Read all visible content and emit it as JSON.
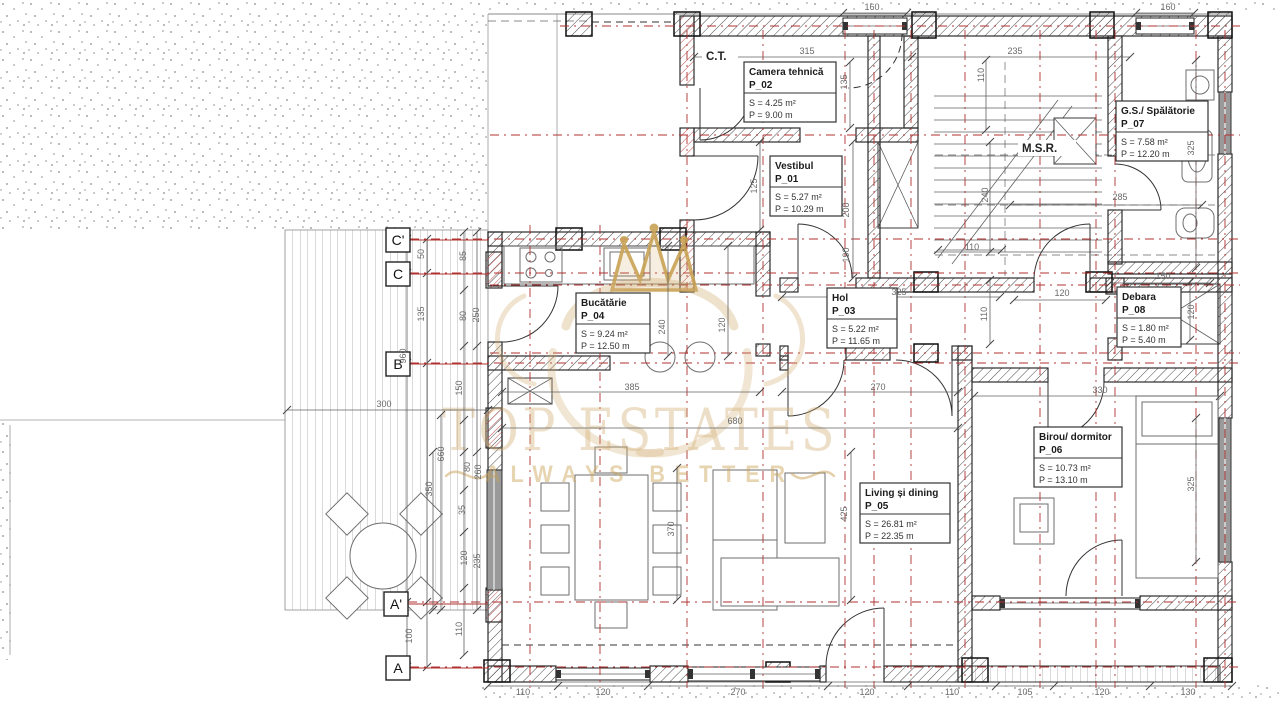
{
  "plan": {
    "watermark": {
      "line1": "TOP ESTATES",
      "line2": "ALWAYS BETTER"
    },
    "small_labels": [
      {
        "id": "ct",
        "text": "C.T.",
        "x": 706,
        "y": 60,
        "w": 36
      },
      {
        "id": "msr",
        "text": "M.S.R.",
        "x": 1022,
        "y": 152,
        "w": 58
      }
    ],
    "rooms": [
      {
        "id": "vestibul",
        "name": "Vestibul",
        "code": "P_01",
        "area": "S = 5.27 m²",
        "perimeter": "P = 10.29 m",
        "x": 770,
        "y": 156,
        "w": 72
      },
      {
        "id": "camera-tehnica",
        "name": "Camera tehnică",
        "code": "P_02",
        "area": "S = 4.25 m²",
        "perimeter": "P = 9.00 m",
        "x": 744,
        "y": 62,
        "w": 92
      },
      {
        "id": "hol",
        "name": "Hol",
        "code": "P_03",
        "area": "S = 5.22 m²",
        "perimeter": "P = 11.65 m",
        "x": 827,
        "y": 288,
        "w": 70
      },
      {
        "id": "bucatarie",
        "name": "Bucătărie",
        "code": "P_04",
        "area": "S = 9.24 m²",
        "perimeter": "P = 12.50 m",
        "x": 576,
        "y": 293,
        "w": 74
      },
      {
        "id": "living",
        "name": "Living și dining",
        "code": "P_05",
        "area": "S = 26.81 m²",
        "perimeter": "P = 22.35 m",
        "x": 860,
        "y": 483,
        "w": 90
      },
      {
        "id": "birou",
        "name": "Birou/ dormitor",
        "code": "P_06",
        "area": "S = 10.73 m²",
        "perimeter": "P = 13.10 m",
        "x": 1034,
        "y": 427,
        "w": 88
      },
      {
        "id": "gs-spalatorie",
        "name": "G.S./ Spălătorie",
        "code": "P_07",
        "area": "S = 7.58 m²",
        "perimeter": "P = 12.20 m",
        "x": 1116,
        "y": 101,
        "w": 92
      },
      {
        "id": "debara",
        "name": "Debara",
        "code": "P_08",
        "area": "S = 1.80 m²",
        "perimeter": "P = 5.40 m",
        "x": 1117,
        "y": 287,
        "w": 64
      }
    ],
    "grid_markers": [
      {
        "label": "C'",
        "x": 386,
        "y": 228
      },
      {
        "label": "C",
        "x": 386,
        "y": 262
      },
      {
        "label": "B",
        "x": 386,
        "y": 352
      },
      {
        "label": "A'",
        "x": 384,
        "y": 592
      },
      {
        "label": "A",
        "x": 386,
        "y": 656
      }
    ],
    "dimensions": [
      {
        "v": "160",
        "x": 872,
        "y": 10
      },
      {
        "v": "160",
        "x": 1168,
        "y": 10
      },
      {
        "v": "315",
        "x": 807,
        "y": 54
      },
      {
        "v": "235",
        "x": 1015,
        "y": 54
      },
      {
        "v": "110",
        "x": 984,
        "y": 75,
        "r": 1
      },
      {
        "v": "135",
        "x": 847,
        "y": 82,
        "r": 1
      },
      {
        "v": "125",
        "x": 757,
        "y": 186,
        "r": 1
      },
      {
        "v": "200",
        "x": 849,
        "y": 210,
        "r": 1
      },
      {
        "v": "190",
        "x": 849,
        "y": 255,
        "r": 1
      },
      {
        "v": "240",
        "x": 988,
        "y": 195,
        "r": 1
      },
      {
        "v": "110",
        "x": 972,
        "y": 250
      },
      {
        "v": "285",
        "x": 1120,
        "y": 200
      },
      {
        "v": "325",
        "x": 1194,
        "y": 148,
        "r": 1
      },
      {
        "v": "150",
        "x": 1163,
        "y": 279
      },
      {
        "v": "325",
        "x": 899,
        "y": 295
      },
      {
        "v": "110",
        "x": 987,
        "y": 314,
        "r": 1
      },
      {
        "v": "120",
        "x": 1062,
        "y": 296
      },
      {
        "v": "120",
        "x": 1194,
        "y": 312,
        "r": 1
      },
      {
        "v": "240",
        "x": 665,
        "y": 327,
        "r": 1
      },
      {
        "v": "120",
        "x": 725,
        "y": 325,
        "r": 1
      },
      {
        "v": "385",
        "x": 632,
        "y": 390
      },
      {
        "v": "270",
        "x": 878,
        "y": 390
      },
      {
        "v": "330",
        "x": 1100,
        "y": 393
      },
      {
        "v": "680",
        "x": 735,
        "y": 424
      },
      {
        "v": "425",
        "x": 847,
        "y": 514,
        "r": 1
      },
      {
        "v": "370",
        "x": 674,
        "y": 529,
        "r": 1
      },
      {
        "v": "325",
        "x": 1194,
        "y": 484,
        "r": 1
      },
      {
        "v": "50",
        "x": 424,
        "y": 254,
        "r": 1
      },
      {
        "v": "135",
        "x": 424,
        "y": 314,
        "r": 1
      },
      {
        "v": "960",
        "x": 406,
        "y": 356,
        "r": 1
      },
      {
        "v": "100",
        "x": 412,
        "y": 636,
        "r": 1
      },
      {
        "v": "300",
        "x": 384,
        "y": 407
      },
      {
        "v": "350",
        "x": 432,
        "y": 489,
        "r": 1
      },
      {
        "v": "660",
        "x": 444,
        "y": 454,
        "r": 1
      },
      {
        "v": "85",
        "x": 466,
        "y": 256,
        "r": 1
      },
      {
        "v": "80",
        "x": 466,
        "y": 316,
        "r": 1
      },
      {
        "v": "250",
        "x": 479,
        "y": 315,
        "r": 1
      },
      {
        "v": "150",
        "x": 462,
        "y": 388,
        "r": 1
      },
      {
        "v": "80",
        "x": 470,
        "y": 467,
        "r": 1
      },
      {
        "v": "260",
        "x": 481,
        "y": 472,
        "r": 1
      },
      {
        "v": "35",
        "x": 465,
        "y": 510,
        "r": 1
      },
      {
        "v": "120",
        "x": 467,
        "y": 558,
        "r": 1
      },
      {
        "v": "235",
        "x": 480,
        "y": 561,
        "r": 1
      },
      {
        "v": "110",
        "x": 462,
        "y": 629,
        "r": 1
      },
      {
        "v": "110",
        "x": 523,
        "y": 695
      },
      {
        "v": "120",
        "x": 603,
        "y": 695
      },
      {
        "v": "270",
        "x": 738,
        "y": 695
      },
      {
        "v": "120",
        "x": 867,
        "y": 695
      },
      {
        "v": "110",
        "x": 952,
        "y": 695
      },
      {
        "v": "105",
        "x": 1025,
        "y": 695
      },
      {
        "v": "120",
        "x": 1102,
        "y": 695
      },
      {
        "v": "130",
        "x": 1188,
        "y": 695
      }
    ],
    "colors": {
      "axis_red": "#b03030",
      "wall_line": "#2b2b2b",
      "dimension_text": "#6a6a6a",
      "watermark_gold": "#cfa96b"
    }
  }
}
